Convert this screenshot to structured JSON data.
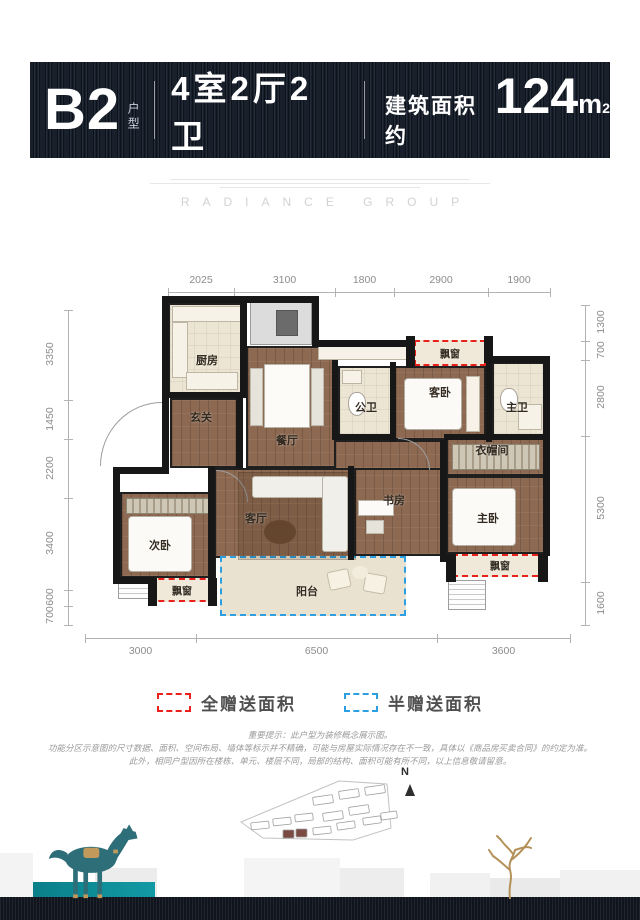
{
  "header": {
    "unit": "B2",
    "unit_suffix": "户型",
    "layout": "4室2厅2卫",
    "area_prefix": "建筑面积约",
    "area_value": "124",
    "area_unit": "m",
    "area_sup": "2"
  },
  "brand": {
    "name": "RADIANCE GROUP"
  },
  "plan": {
    "dims": {
      "top": {
        "y": 292,
        "x1": 168,
        "x2": 550,
        "label_y": 274,
        "ticks": [
          168,
          234,
          335,
          394,
          488,
          550
        ],
        "labels": [
          "2025",
          "3100",
          "1800",
          "2900",
          "1900"
        ]
      },
      "bottom": {
        "y": 638,
        "x1": 85,
        "x2": 570,
        "label_y": 645,
        "ticks": [
          85,
          196,
          437,
          570
        ],
        "labels": [
          "3000",
          "6500",
          "3600"
        ]
      },
      "left": {
        "x": 68,
        "y1": 310,
        "y2": 625,
        "label_x": 50,
        "ticks": [
          310,
          400,
          439,
          498,
          590,
          606,
          625
        ],
        "labels": [
          "3350",
          "1450",
          "2200",
          "3400",
          "600",
          "700"
        ]
      },
      "right": {
        "x": 585,
        "y1": 305,
        "y2": 625,
        "label_x": 601,
        "ticks": [
          305,
          341,
          360,
          436,
          582,
          625
        ],
        "labels": [
          "1300",
          "700",
          "2800",
          "5300",
          "1600"
        ]
      }
    },
    "rooms": [
      {
        "name": "kitchen",
        "label": "厨房",
        "type": "tile",
        "x": 168,
        "y": 303,
        "w": 78,
        "h": 93,
        "lx": 207,
        "ly": 360
      },
      {
        "name": "shaft",
        "label": "",
        "type": "shaft",
        "x": 250,
        "y": 301,
        "w": 62,
        "h": 44
      },
      {
        "name": "foyer",
        "label": "玄关",
        "type": "wood",
        "x": 170,
        "y": 398,
        "w": 70,
        "h": 70,
        "lx": 201,
        "ly": 417
      },
      {
        "name": "dining",
        "label": "餐厅",
        "type": "wood",
        "x": 246,
        "y": 346,
        "w": 90,
        "h": 122,
        "lx": 287,
        "ly": 440
      },
      {
        "name": "public-bath",
        "label": "公卫",
        "type": "tile",
        "x": 338,
        "y": 366,
        "w": 54,
        "h": 70,
        "lx": 366,
        "ly": 407
      },
      {
        "name": "guest-bedroom",
        "label": "客卧",
        "type": "wood",
        "x": 394,
        "y": 366,
        "w": 92,
        "h": 74,
        "lx": 440,
        "ly": 392
      },
      {
        "name": "bay-window-top",
        "label": "飘窗",
        "type": "bay",
        "x": 414,
        "y": 340,
        "w": 72,
        "h": 26,
        "lx": 450,
        "ly": 353
      },
      {
        "name": "master-bath",
        "label": "主卫",
        "type": "tile",
        "x": 492,
        "y": 362,
        "w": 56,
        "h": 74,
        "lx": 517,
        "ly": 407
      },
      {
        "name": "closet",
        "label": "衣帽间",
        "type": "wood",
        "x": 446,
        "y": 438,
        "w": 102,
        "h": 38,
        "lx": 492,
        "ly": 450
      },
      {
        "name": "hallway",
        "label": "",
        "type": "wood",
        "x": 334,
        "y": 440,
        "w": 112,
        "h": 30
      },
      {
        "name": "study",
        "label": "书房",
        "type": "wood",
        "x": 354,
        "y": 468,
        "w": 92,
        "h": 88,
        "lx": 394,
        "ly": 500
      },
      {
        "name": "living",
        "label": "客厅",
        "type": "wood",
        "x": 214,
        "y": 468,
        "w": 140,
        "h": 90,
        "lx": 256,
        "ly": 518
      },
      {
        "name": "second-bedroom",
        "label": "次卧",
        "type": "wood",
        "x": 120,
        "y": 492,
        "w": 96,
        "h": 86,
        "lx": 160,
        "ly": 545
      },
      {
        "name": "bay-window-left",
        "label": "飘窗",
        "type": "bay",
        "x": 148,
        "y": 578,
        "w": 68,
        "h": 24,
        "lx": 182,
        "ly": 590
      },
      {
        "name": "master-bedroom",
        "label": "主卧",
        "type": "wood",
        "x": 446,
        "y": 476,
        "w": 102,
        "h": 78,
        "lx": 488,
        "ly": 518
      },
      {
        "name": "bay-window-right",
        "label": "飘窗",
        "type": "bay",
        "x": 452,
        "y": 554,
        "w": 96,
        "h": 23,
        "lx": 500,
        "ly": 565
      },
      {
        "name": "balcony",
        "label": "阳台",
        "type": "balcony",
        "x": 220,
        "y": 556,
        "w": 186,
        "h": 60,
        "lx": 307,
        "ly": 591
      }
    ],
    "walls": [
      [
        162,
        296,
        154,
        7
      ],
      [
        162,
        296,
        7,
        178
      ],
      [
        115,
        467,
        54,
        7
      ],
      [
        113,
        467,
        7,
        117
      ],
      [
        113,
        577,
        42,
        7
      ],
      [
        240,
        300,
        7,
        98
      ],
      [
        236,
        396,
        7,
        72
      ],
      [
        168,
        392,
        76,
        6
      ],
      [
        312,
        296,
        7,
        51
      ],
      [
        312,
        340,
        102,
        7
      ],
      [
        406,
        336,
        9,
        32
      ],
      [
        484,
        336,
        9,
        27
      ],
      [
        484,
        356,
        66,
        7
      ],
      [
        543,
        356,
        7,
        200
      ],
      [
        332,
        360,
        6,
        80
      ],
      [
        390,
        362,
        6,
        80
      ],
      [
        486,
        356,
        6,
        86
      ],
      [
        332,
        434,
        64,
        6
      ],
      [
        444,
        434,
        104,
        6
      ],
      [
        440,
        440,
        7,
        122
      ],
      [
        348,
        466,
        6,
        94
      ],
      [
        208,
        466,
        7,
        114
      ],
      [
        148,
        578,
        9,
        28
      ],
      [
        208,
        578,
        9,
        28
      ],
      [
        446,
        554,
        10,
        28
      ],
      [
        538,
        554,
        10,
        28
      ]
    ],
    "furniture": [
      {
        "type": "counter",
        "x": 172,
        "y": 306,
        "w": 70,
        "h": 16
      },
      {
        "type": "counter",
        "x": 172,
        "y": 322,
        "w": 16,
        "h": 56
      },
      {
        "type": "counter",
        "x": 186,
        "y": 372,
        "w": 52,
        "h": 18
      },
      {
        "type": "counter",
        "x": 318,
        "y": 344,
        "w": 96,
        "h": 16
      },
      {
        "type": "panel",
        "x": 276,
        "y": 310,
        "w": 22,
        "h": 26,
        "c": "#6b6b6b"
      },
      {
        "type": "chairs",
        "x": 250,
        "y": 368,
        "w": 13,
        "h": 58
      },
      {
        "type": "table",
        "x": 264,
        "y": 364,
        "w": 46,
        "h": 64
      },
      {
        "type": "chairs",
        "x": 311,
        "y": 368,
        "w": 13,
        "h": 58
      },
      {
        "type": "counter",
        "x": 342,
        "y": 370,
        "w": 20,
        "h": 14
      },
      {
        "type": "toilet",
        "x": 348,
        "y": 392,
        "w": 18,
        "h": 24
      },
      {
        "type": "bed",
        "x": 404,
        "y": 378,
        "w": 58,
        "h": 52
      },
      {
        "type": "counter",
        "x": 466,
        "y": 376,
        "w": 14,
        "h": 56
      },
      {
        "type": "toilet",
        "x": 500,
        "y": 388,
        "w": 18,
        "h": 24
      },
      {
        "type": "counter",
        "x": 518,
        "y": 404,
        "w": 24,
        "h": 26
      },
      {
        "type": "wardrobe",
        "x": 452,
        "y": 444,
        "w": 88,
        "h": 26
      },
      {
        "type": "wardrobe",
        "x": 126,
        "y": 498,
        "w": 84,
        "h": 16
      },
      {
        "type": "bed",
        "x": 128,
        "y": 516,
        "w": 64,
        "h": 56
      },
      {
        "type": "rug",
        "x": 238,
        "y": 472,
        "w": 118,
        "h": 88
      },
      {
        "type": "sofa",
        "x": 252,
        "y": 476,
        "w": 76,
        "h": 22
      },
      {
        "type": "sofa",
        "x": 322,
        "y": 476,
        "w": 26,
        "h": 76
      },
      {
        "type": "round",
        "x": 264,
        "y": 520,
        "w": 32,
        "h": 24
      },
      {
        "type": "table",
        "x": 358,
        "y": 500,
        "w": 36,
        "h": 16
      },
      {
        "type": "chairs",
        "x": 366,
        "y": 520,
        "w": 18,
        "h": 14
      },
      {
        "type": "bed",
        "x": 452,
        "y": 488,
        "w": 64,
        "h": 58
      },
      {
        "type": "cushion",
        "x": 328,
        "y": 570,
        "w": 22,
        "h": 19,
        "rot": -12
      },
      {
        "type": "cushion",
        "x": 364,
        "y": 574,
        "w": 22,
        "h": 19,
        "rot": 10
      },
      {
        "type": "round",
        "x": 352,
        "y": 566,
        "w": 16,
        "h": 13,
        "c": "#f2ecdc"
      },
      {
        "type": "ac",
        "x": 118,
        "y": 582,
        "w": 36,
        "h": 17
      },
      {
        "type": "ac",
        "x": 448,
        "y": 580,
        "w": 38,
        "h": 30
      },
      {
        "type": "arc",
        "x": 100,
        "y": 402,
        "w": 62,
        "h": 64,
        "corner": "tl"
      },
      {
        "type": "arc",
        "x": 398,
        "y": 438,
        "w": 32,
        "h": 32,
        "corner": "tr"
      },
      {
        "type": "arc",
        "x": 216,
        "y": 470,
        "w": 32,
        "h": 32,
        "corner": "tr"
      }
    ]
  },
  "legend": {
    "items": [
      {
        "label": "全赠送面积",
        "color": "#e8211d"
      },
      {
        "label": "半赠送面积",
        "color": "#2b9fe0"
      }
    ]
  },
  "disclaimer": [
    "重要提示：此户型为装修概念展示图。",
    "功能分区示意图的尺寸数据、面积、空间布局、墙体等标示并不精确，可能与房屋实际情况存在不一致，具体以《商品房买卖合同》的约定为准。",
    "此外，相同户型因所在楼栋、单元、楼层不同，局部的结构、面积可能有所不同，以上信息敬请留意。"
  ],
  "siteplan": {
    "north_label": "N",
    "boundary": "6,50 104,9 152,12 156,56 118,68 28,66",
    "highlight_color": "#7b4a42",
    "buildings": [
      {
        "x": 78,
        "y": 24,
        "w": 20,
        "h": 8,
        "r": -8,
        "f": 0
      },
      {
        "x": 104,
        "y": 18,
        "w": 20,
        "h": 8,
        "r": -8,
        "f": 0
      },
      {
        "x": 130,
        "y": 14,
        "w": 20,
        "h": 8,
        "r": -8,
        "f": 0
      },
      {
        "x": 16,
        "y": 50,
        "w": 18,
        "h": 7,
        "r": -6,
        "f": 0
      },
      {
        "x": 38,
        "y": 46,
        "w": 18,
        "h": 7,
        "r": -6,
        "f": 0
      },
      {
        "x": 60,
        "y": 42,
        "w": 18,
        "h": 7,
        "r": -6,
        "f": 0
      },
      {
        "x": 88,
        "y": 40,
        "w": 20,
        "h": 8,
        "r": -8,
        "f": 0
      },
      {
        "x": 114,
        "y": 34,
        "w": 20,
        "h": 8,
        "r": -8,
        "f": 0
      },
      {
        "x": 48,
        "y": 58,
        "w": 11,
        "h": 8,
        "r": 0,
        "f": 1
      },
      {
        "x": 61,
        "y": 57,
        "w": 11,
        "h": 8,
        "r": 0,
        "f": 1
      },
      {
        "x": 78,
        "y": 55,
        "w": 18,
        "h": 7,
        "r": -6,
        "f": 0
      },
      {
        "x": 102,
        "y": 50,
        "w": 18,
        "h": 7,
        "r": -8,
        "f": 0
      },
      {
        "x": 128,
        "y": 45,
        "w": 18,
        "h": 7,
        "r": -8,
        "f": 0
      },
      {
        "x": 146,
        "y": 40,
        "w": 16,
        "h": 7,
        "r": -8,
        "f": 0
      }
    ]
  },
  "colors": {
    "accent_red": "#e8211d",
    "accent_blue": "#2b9fe0",
    "banner_navy": "#18202e",
    "teal": "#0d8a93",
    "site_highlight": "#7b4a42"
  }
}
